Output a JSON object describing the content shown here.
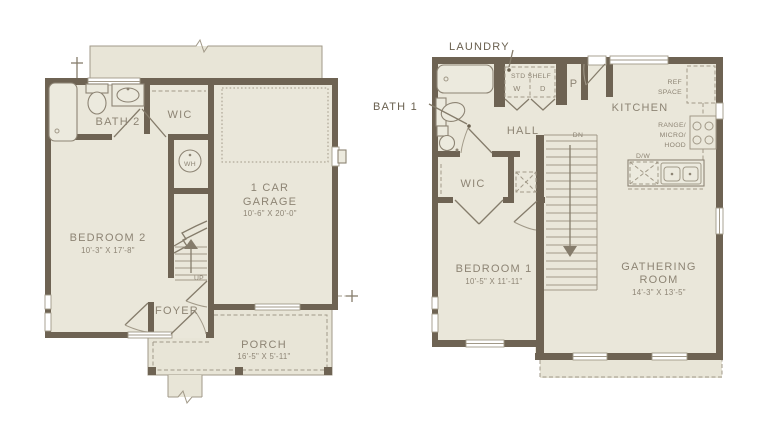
{
  "colors": {
    "wall": "#6e6353",
    "floor": "#eae7da",
    "exterior_slab": "#e8e5d7",
    "thin_line": "#a19988",
    "label": "#8d8474",
    "dark_label": "#6a604f",
    "background": "#ffffff"
  },
  "floor1": {
    "bath2_label": "BATH 2",
    "wic_label": "WIC",
    "garage_line1": "1 CAR",
    "garage_line2": "GARAGE",
    "garage_dims": "10'-6\" X 20'-0\"",
    "wh_label": "WH",
    "bedroom2_label": "BEDROOM 2",
    "bedroom2_dims": "10'-3\" X 17'-8\"",
    "up_label": "UP",
    "foyer_label": "FOYER",
    "porch_label": "PORCH",
    "porch_dims": "16'-5\" X 5'-11\""
  },
  "floor2": {
    "laundry_label": "LAUNDRY",
    "bath1_label": "BATH 1",
    "shelf_label": "STD SHELF",
    "washer_label": "W",
    "dryer_label": "D",
    "pantry_label": "P",
    "hall_label": "HALL",
    "kitchen_label": "KITCHEN",
    "ref_line1": "REF",
    "ref_line2": "SPACE",
    "range_line1": "RANGE/",
    "range_line2": "MICRO/",
    "range_line3": "HOOD",
    "dw_label": "D/W",
    "dn_label": "DN",
    "wic_label": "WIC",
    "bedroom1_label": "BEDROOM 1",
    "bedroom1_dims": "10'-5\" X 11'-11\"",
    "gathering_line1": "GATHERING",
    "gathering_line2": "ROOM",
    "gathering_dims": "14'-3\" X 13'-5\""
  }
}
